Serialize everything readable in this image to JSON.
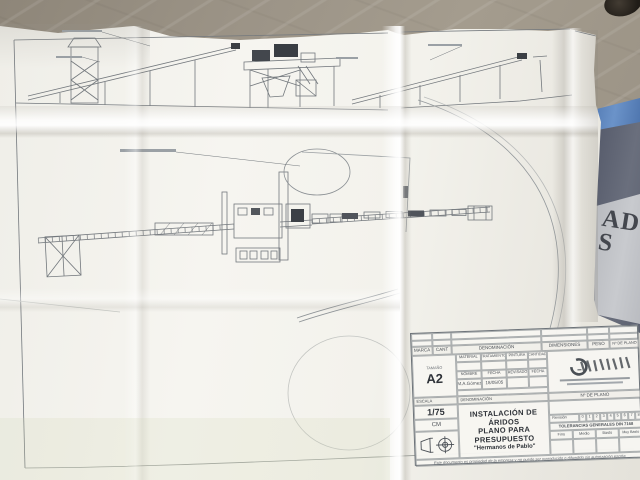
{
  "scene": {
    "table_color": "#9c9487",
    "paper_color": "#f3f2ec",
    "tape_color": "#4d74ad",
    "line_color": "#73787d"
  },
  "side_document": {
    "letters": [
      "AD",
      "S"
    ]
  },
  "title_block": {
    "parts_list_headers": [
      "MARCA",
      "CANT",
      "DENOMINACIÓN",
      "DIMENSIONES",
      "PESO",
      "Nº DE PLANO"
    ],
    "size": {
      "label": "TAMAÑO",
      "value": "A2"
    },
    "spec_headers": [
      "MATERIAL",
      "TRATAMIENTO",
      "PINTURA",
      "CANTIDAD"
    ],
    "sign_headers": [
      "NOMBRE",
      "FECHA",
      "REVISADO",
      "FECHA"
    ],
    "sign_values": [
      "M.A.Gómez",
      "18/05/05"
    ],
    "scale": {
      "label": "ESCALA",
      "value": "1/75",
      "unit": "CM"
    },
    "denomination": {
      "label": "DENOMINACIÓN",
      "line1": "INSTALACIÓN DE ÁRIDOS",
      "line2": "PLANO PARA PRESUPUESTO",
      "line3": "\"Hermanos de Pablo\""
    },
    "plano_box_label": "Nº DE PLANO",
    "revision": {
      "label": "Revisión",
      "cells": [
        "0",
        "1",
        "2",
        "3",
        "4",
        "5",
        "6",
        "7",
        "8"
      ]
    },
    "tolerances": {
      "label": "TOLERANCIAS GENERALES DIN 7168",
      "classes": [
        "Fino",
        "Medio",
        "Basto",
        "Muy Basto"
      ]
    },
    "fine_print": "Este documento es propiedad de la empresa y no puede ser reproducido o difundido sin autorización escrita"
  }
}
